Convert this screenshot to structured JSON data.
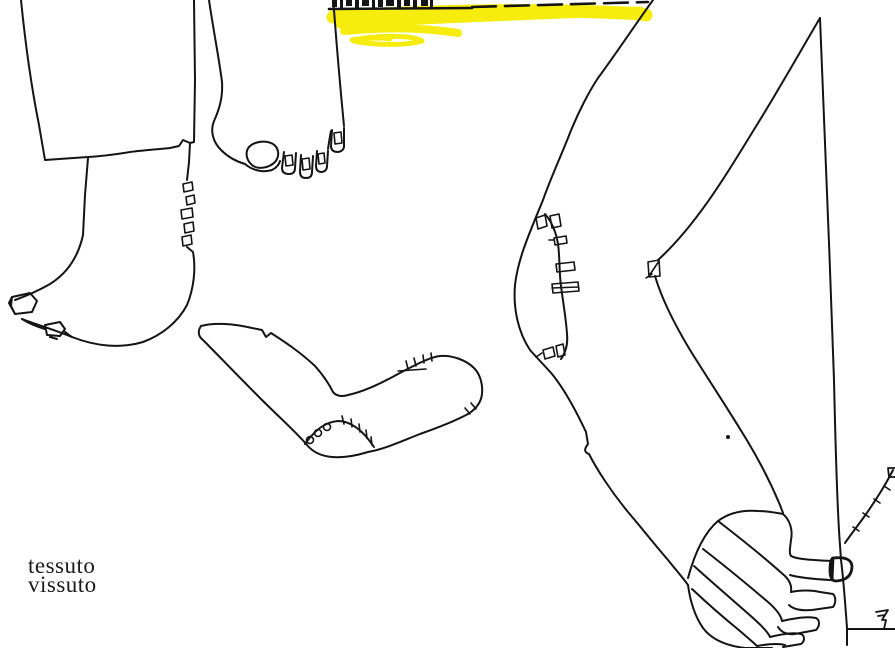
{
  "canvas": {
    "width": 895,
    "height": 648,
    "background": "#ffffff"
  },
  "signature": {
    "line1": "tessuto",
    "line2": "vissuto"
  },
  "colors": {
    "ink": "#141414",
    "highlight": "#f6ec0e",
    "text": "#1a1a1a"
  },
  "drawing": {
    "elements": [
      {
        "name": "trouser-hem"
      },
      {
        "name": "bare-foot-profile-with-big-toe"
      },
      {
        "name": "heel-stitch-marks"
      },
      {
        "name": "bare-foot-front-with-toes"
      },
      {
        "name": "yellow-highlighter-stroke"
      },
      {
        "name": "dashed-hem-line"
      },
      {
        "name": "cropped-text-marks"
      },
      {
        "name": "darned-sock"
      },
      {
        "name": "leg-with-mended-knee"
      },
      {
        "name": "arm-with-fist-pointing-finger"
      },
      {
        "name": "sleeve-cuff-stitches"
      },
      {
        "name": "pointer-glyph"
      }
    ]
  }
}
